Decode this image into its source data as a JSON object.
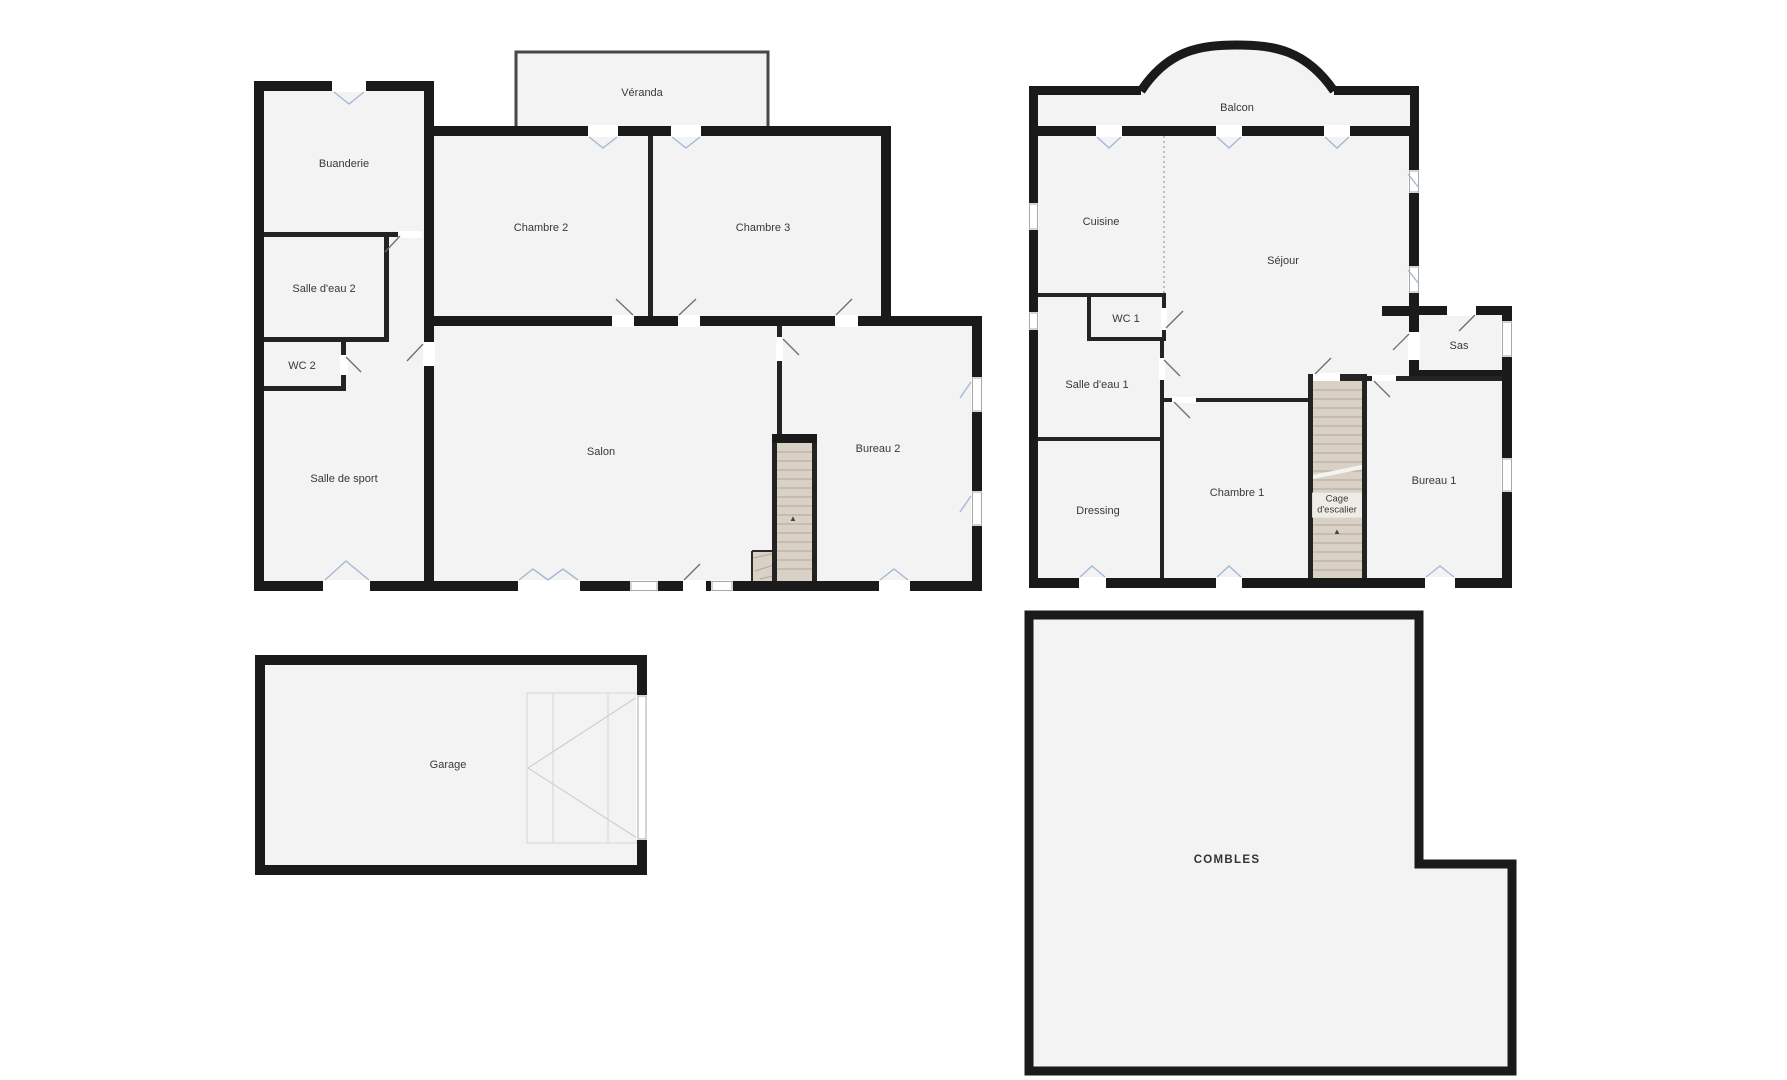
{
  "title": "Plans de la maison",
  "palette": {
    "wall": "#1a1a1a",
    "room_fill": "#f3f3f4",
    "stairs_fill": "#d9d1c5",
    "window_glyph": "#a3bad4",
    "background": "#ffffff",
    "label_text": "#383838"
  },
  "ground_floor": {
    "rooms": {
      "buanderie": "Buanderie",
      "salle_eau_2": "Salle d'eau 2",
      "wc_2": "WC 2",
      "salle_sport": "Salle de sport",
      "chambre_2": "Chambre 2",
      "chambre_3": "Chambre 3",
      "veranda": "Véranda",
      "salon": "Salon",
      "bureau_2": "Bureau 2"
    }
  },
  "first_floor": {
    "rooms": {
      "balcon": "Balcon",
      "cuisine": "Cuisine",
      "sejour": "Séjour",
      "wc_1": "WC 1",
      "salle_eau_1": "Salle d'eau 1",
      "dressing": "Dressing",
      "chambre_1": "Chambre 1",
      "cage_escalier": "Cage d'escalier",
      "bureau_1": "Bureau 1",
      "sas": "Sas"
    }
  },
  "annexes": {
    "garage": "Garage",
    "combles": "COMBLES"
  },
  "stairs": {
    "arrow": "▲"
  }
}
